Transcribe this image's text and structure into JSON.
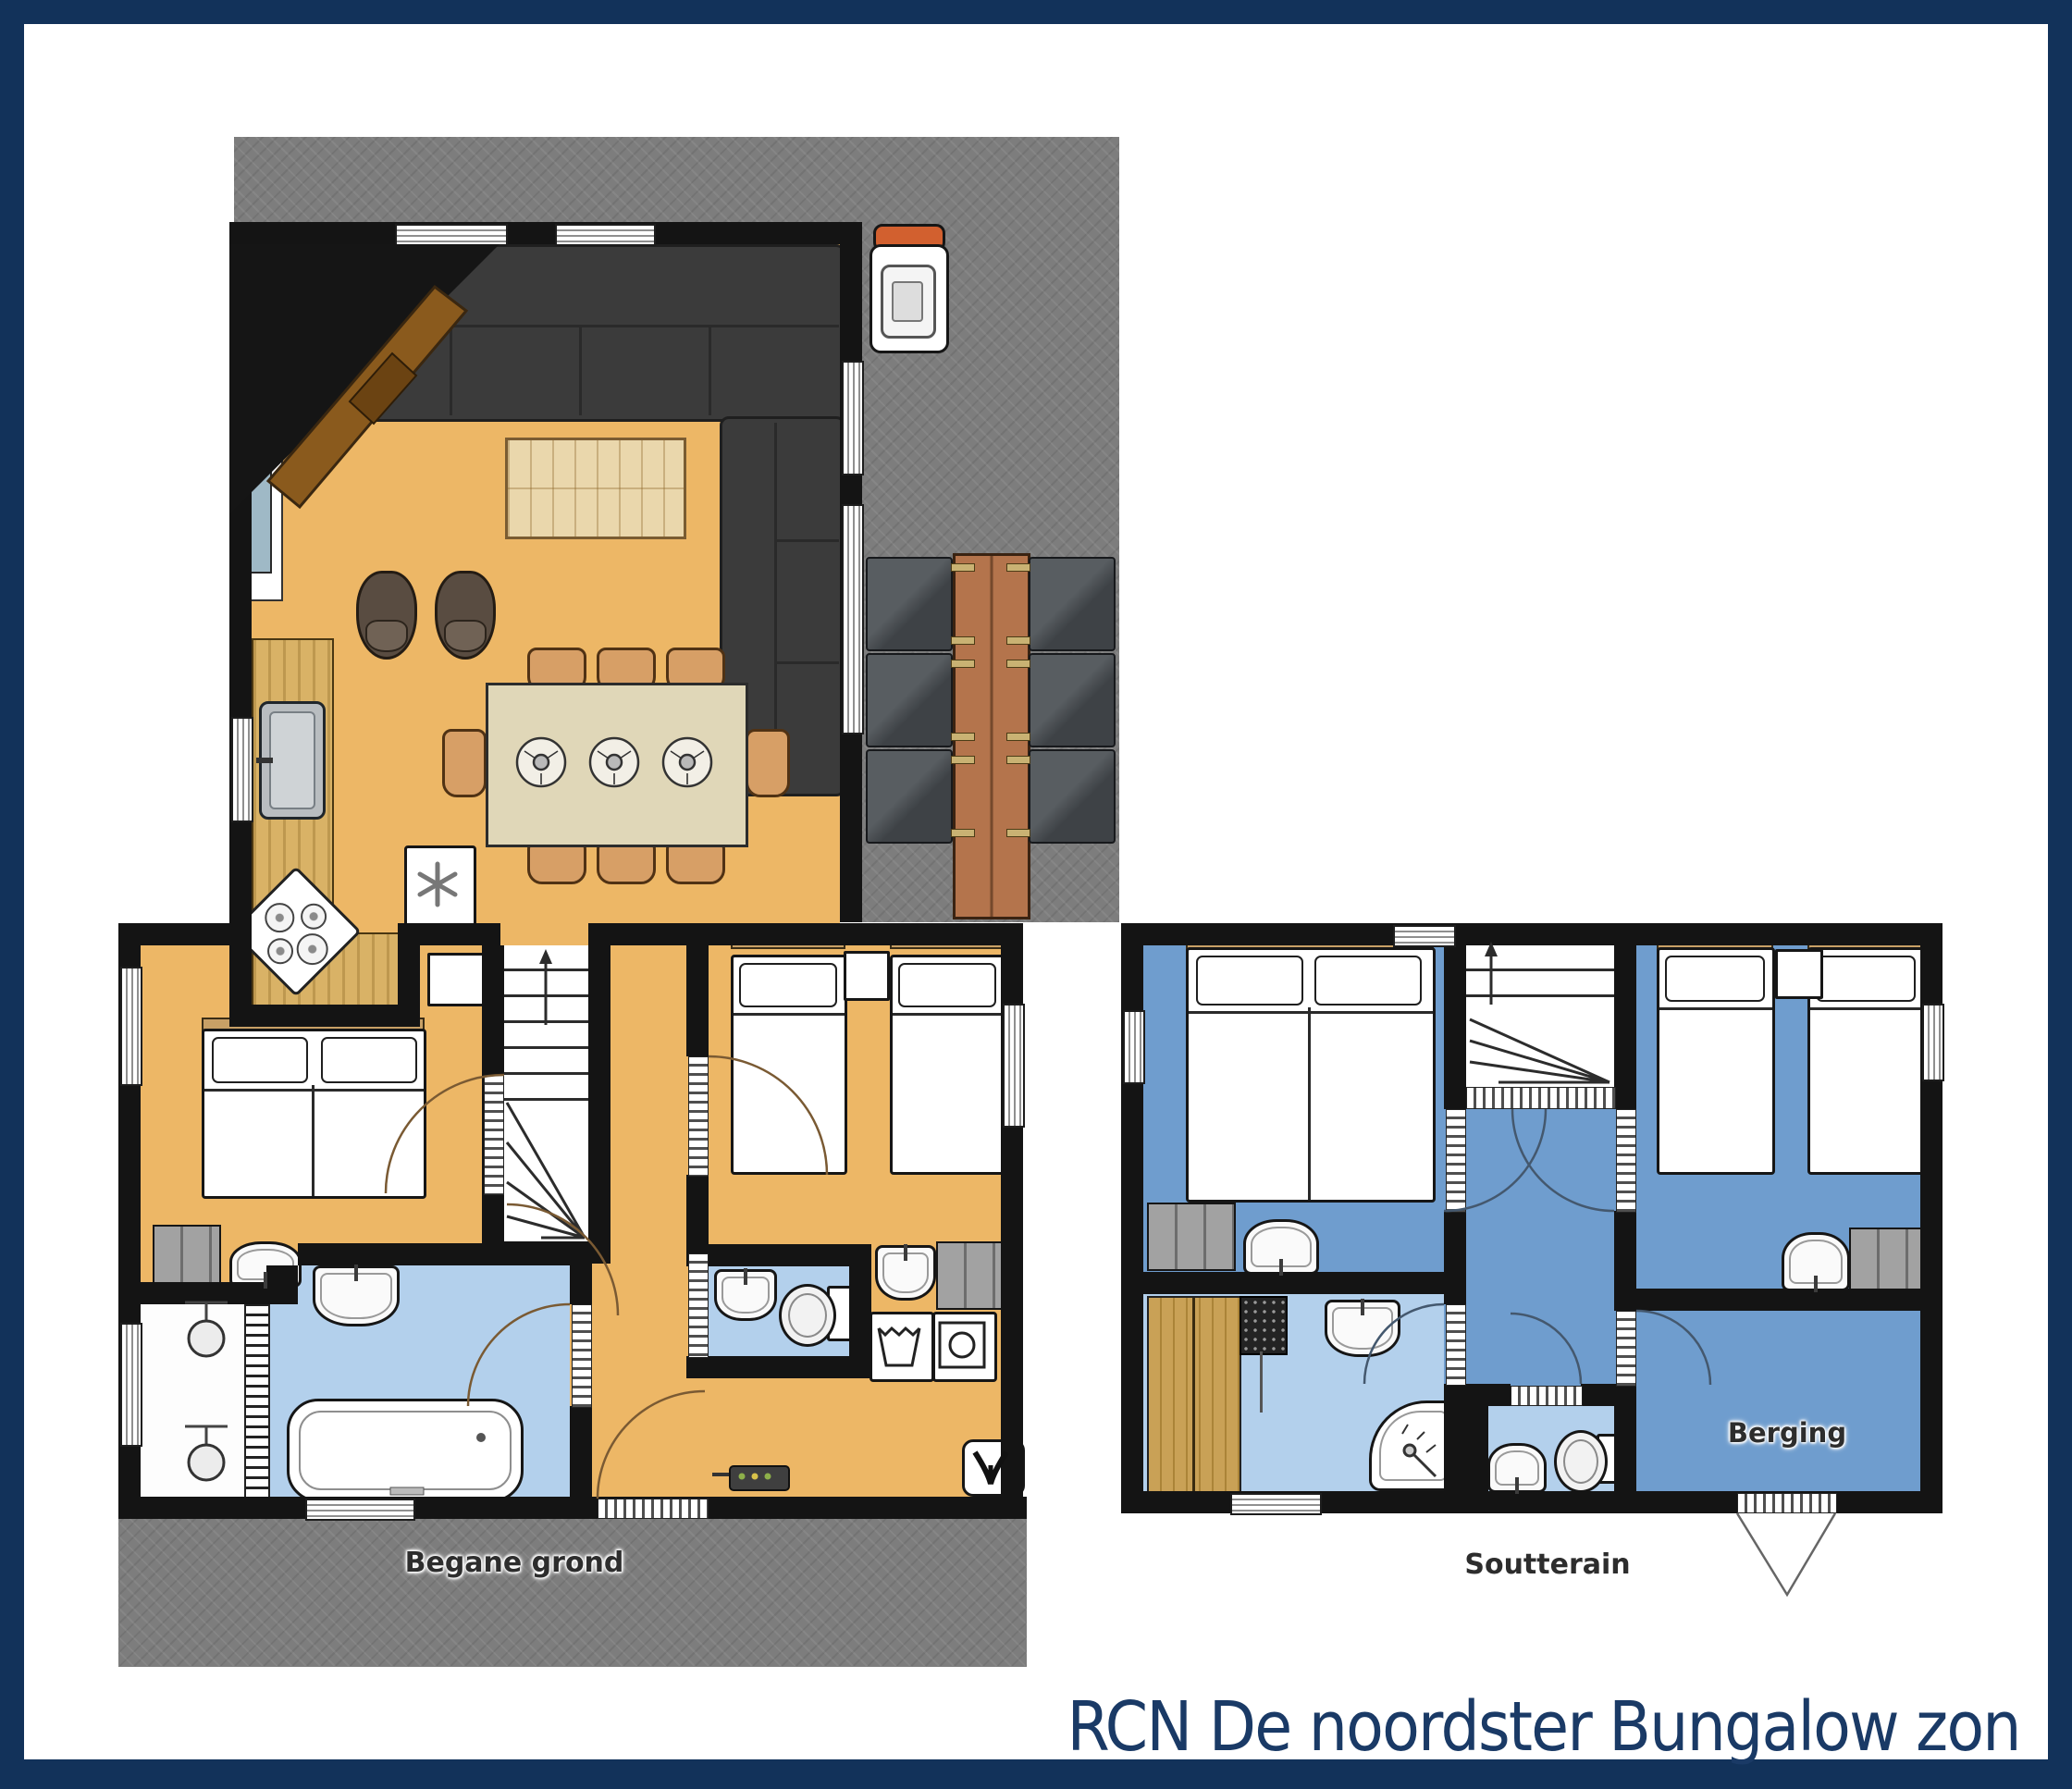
{
  "title": "RCN De noordster Bungalow zon",
  "floors": {
    "ground": {
      "label": "Begane grond"
    },
    "basement": {
      "label": "Soutterain",
      "rooms": {
        "storage": "Berging"
      }
    }
  },
  "colors": {
    "frame_navy": "#12325a",
    "title_navy": "#1a3a66",
    "ground_floor": "#edb766",
    "basement_floor": "#6f9dce",
    "wet_room_floor": "#b3d0ec",
    "terrace_gray": "#7d7d7d",
    "wall_black": "#141414",
    "kitchen_wood": "#d9b266",
    "sauna_wood": "#c9a156",
    "sofa_gray": "#3b3b3b",
    "chair_terracotta": "#d79f66",
    "bbq_lid_orange": "#d2602f"
  }
}
